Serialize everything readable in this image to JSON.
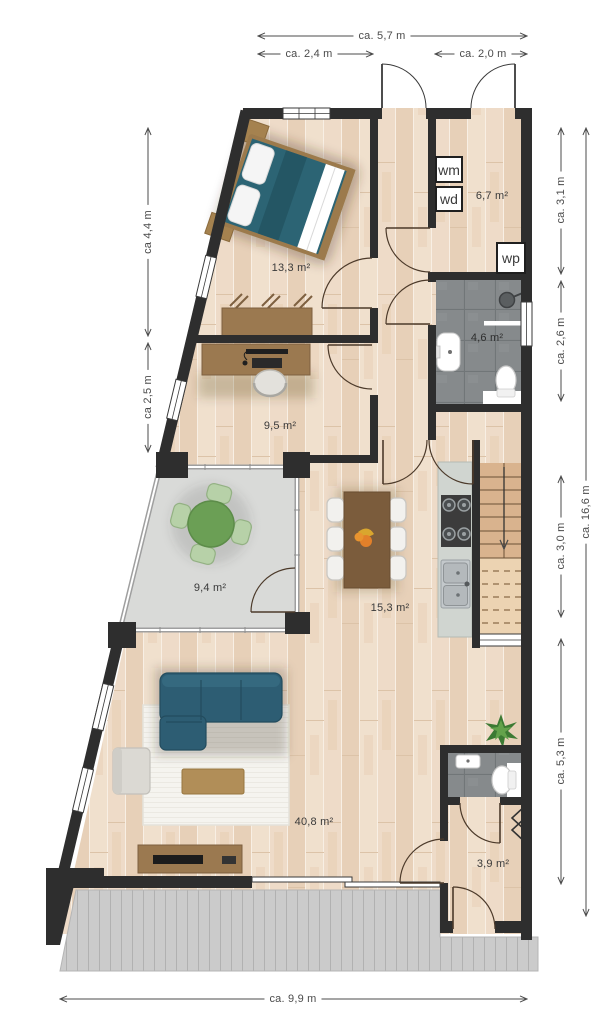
{
  "plan_type": "apartment floor plan",
  "dims": {
    "top_total": "ca. 5,7 m",
    "top_left": "ca. 2,4 m",
    "top_right": "ca. 2,0 m",
    "left_upper": "ca 4,4 m",
    "left_lower": "ca 2,5 m",
    "right_1": "ca. 3,1 m",
    "right_2": "ca. 2,6 m",
    "right_3": "ca. 3,0 m",
    "right_4": "ca. 5,3 m",
    "right_total": "ca. 16,6 m",
    "bottom_total": "ca. 9,9 m"
  },
  "rooms": {
    "bedroom": {
      "area": "13,3 m²"
    },
    "utility": {
      "area": "6,7 m²"
    },
    "bathroom": {
      "area": "4,6 m²"
    },
    "office": {
      "area": "9,5 m²"
    },
    "conservatory": {
      "area": "9,4 m²"
    },
    "kitchen": {
      "area": "15,3 m²"
    },
    "living": {
      "area": "40,8 m²"
    },
    "hall": {
      "area": "3,9 m²"
    }
  },
  "appliances": {
    "washing_machine": "wm",
    "dryer": "wd",
    "heat_pump": "wp"
  },
  "colors": {
    "wall": "#2e2e2e",
    "wood_floor": "#ecd8c3",
    "tile_floor": "#868a8c",
    "terrace": "#cbcbcb",
    "conservatory_floor": "#d9dad8",
    "sofa": "#2d5d73",
    "bed": "#2c6474",
    "dining_green": "#6b9f55",
    "furniture_wood": "#9b7950"
  }
}
